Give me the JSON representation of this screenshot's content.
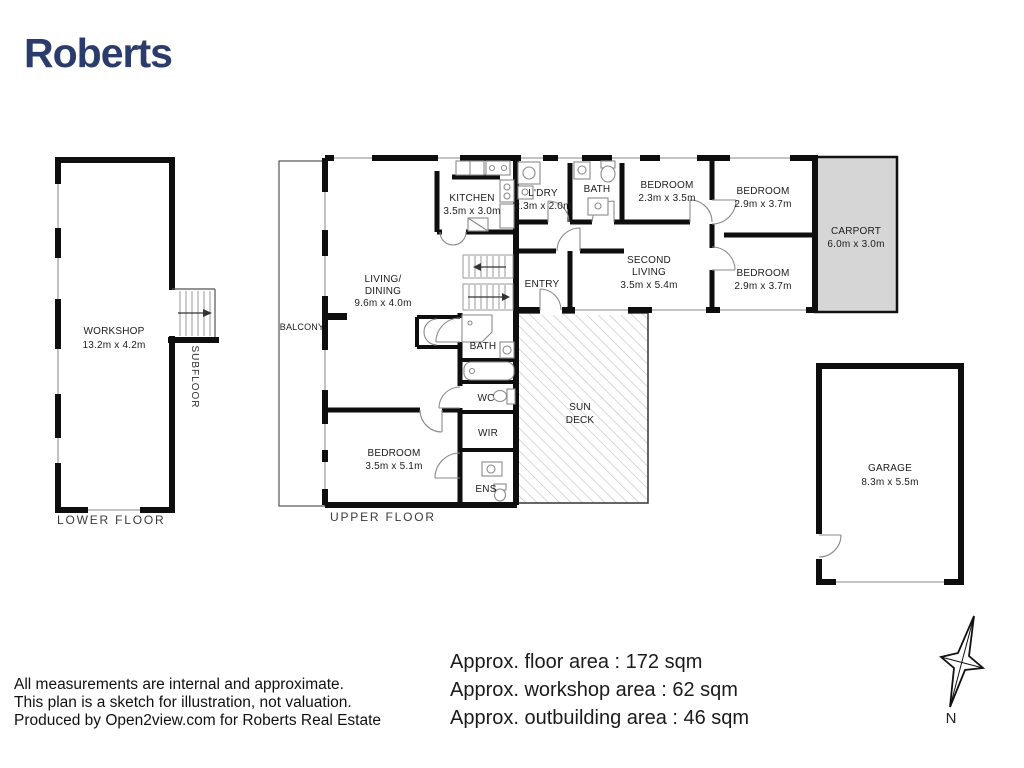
{
  "brand": {
    "name": "Roberts",
    "color": "#2a3b6c"
  },
  "plan": {
    "lower_floor": {
      "floor_label": "LOWER FLOOR",
      "subfloor_label": "SUBFLOOR",
      "workshop": {
        "name": "WORKSHOP",
        "dims": "13.2m x 4.2m"
      }
    },
    "upper_floor": {
      "floor_label": "UPPER FLOOR",
      "balcony": {
        "name": "BALCONY"
      },
      "living_dining": {
        "name_line1": "LIVING/",
        "name_line2": "DINING",
        "dims": "9.6m x 4.0m"
      },
      "kitchen": {
        "name": "KITCHEN",
        "dims": "3.5m x 3.0m"
      },
      "laundry": {
        "name": "L'DRY",
        "dims": "2.3m x 2.0m"
      },
      "bath_top": {
        "name": "BATH"
      },
      "bedroom_top": {
        "name": "BEDROOM",
        "dims": "2.3m x 3.5m"
      },
      "bedroom_right_upper": {
        "name": "BEDROOM",
        "dims": "2.9m x 3.7m"
      },
      "bedroom_right_lower": {
        "name": "BEDROOM",
        "dims": "2.9m x 3.7m"
      },
      "carport": {
        "name": "CARPORT",
        "dims": "6.0m x 3.0m"
      },
      "entry": {
        "name": "ENTRY"
      },
      "second_living": {
        "name_line1": "SECOND",
        "name_line2": "LIVING",
        "dims": "3.5m x 5.4m"
      },
      "bath_mid": {
        "name": "BATH"
      },
      "wc": {
        "name": "WC"
      },
      "wir": {
        "name": "WIR"
      },
      "ens": {
        "name": "ENS"
      },
      "bedroom_lower": {
        "name": "BEDROOM",
        "dims": "3.5m x 5.1m"
      },
      "sun_deck": {
        "name_line1": "SUN",
        "name_line2": "DECK"
      }
    },
    "outbuildings": {
      "garage": {
        "name": "GARAGE",
        "dims": "8.3m x 5.5m"
      }
    }
  },
  "areas": {
    "floor": "Approx. floor area : 172 sqm",
    "workshop": "Approx. workshop area : 62 sqm",
    "outbuilding": "Approx. outbuilding area : 46 sqm"
  },
  "disclaimer": {
    "line1": "All measurements are internal and approximate.",
    "line2": "This plan is a sketch for illustration, not valuation.",
    "line3": "Produced by Open2view.com for Roberts Real Estate"
  },
  "compass": {
    "north_label": "N"
  }
}
